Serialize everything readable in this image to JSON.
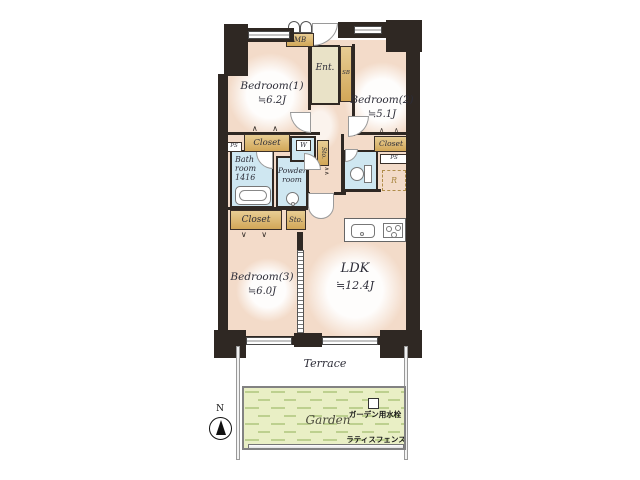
{
  "plan": {
    "rooms": {
      "bedroom1": {
        "name": "Bedroom(1)",
        "size": "≒6.2J"
      },
      "bedroom2": {
        "name": "Bedroom(2)",
        "size": "≒5.1J"
      },
      "bedroom3": {
        "name": "Bedroom(3)",
        "size": "≒6.0J"
      },
      "ldk": {
        "name": "LDK",
        "size": "≒12.4J"
      },
      "bath": {
        "line1": "Bath",
        "line2": "room",
        "line3": "1416"
      },
      "powder": {
        "line1": "Powder",
        "line2": "room"
      },
      "entrance": "Ent."
    },
    "labels": {
      "closet": "Closet",
      "sto": "Sto.",
      "ps": "PS",
      "mb": "MB",
      "sb": "SB",
      "w": "W",
      "r": "R"
    },
    "icons": {
      "folding_door_up": "∧ ∧",
      "folding_door_down": "∨ ∨",
      "bifold": "∧∧"
    }
  },
  "outdoor": {
    "terrace": "Terrace",
    "garden": "Garden",
    "water_tap": "ガーデン用水栓",
    "fence": "ラティスフェンス"
  },
  "compass": {
    "north": "N"
  },
  "colors": {
    "wall": "#2f2823",
    "room_floor": "#f3dbc9",
    "wet_area": "#cfe7f1",
    "closet": "#d9b168",
    "entrance_floor": "#e9e2c7",
    "garden": "#e9efc5",
    "garden_dash": "#bdd08f"
  }
}
